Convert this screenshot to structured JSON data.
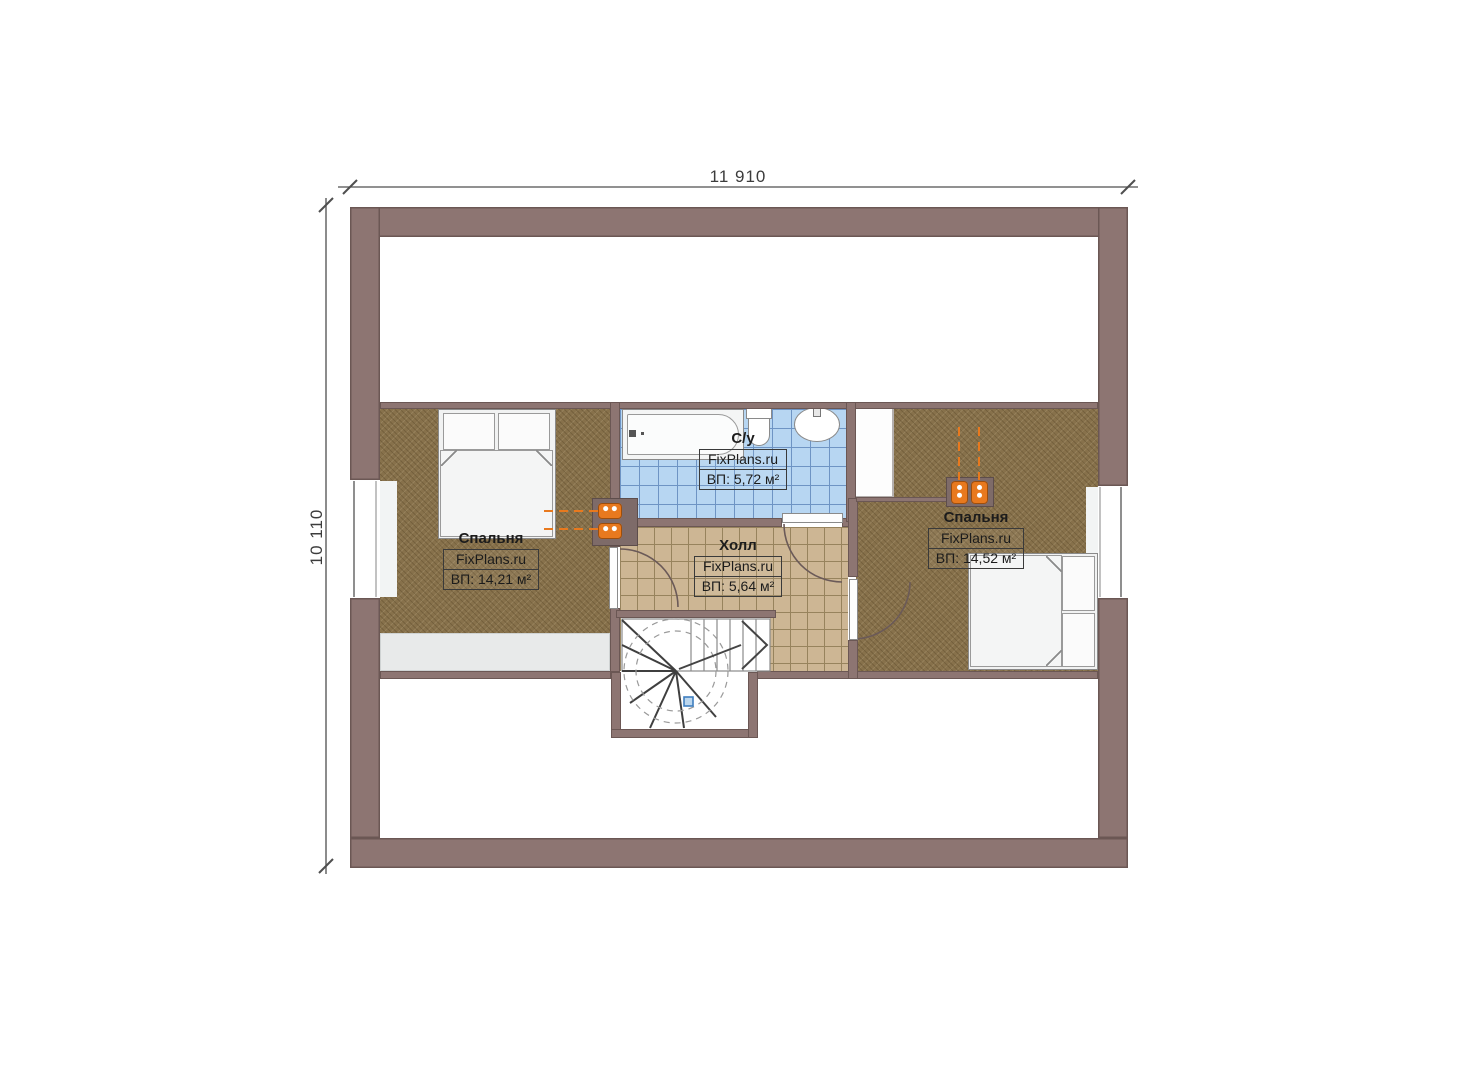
{
  "plan": {
    "dim_top": "11 910",
    "dim_left": "10 110"
  },
  "rooms": {
    "bedroom_left": {
      "name": "Спальня",
      "watermark": "FixPlans.ru",
      "area": "ВП: 14,21 м²"
    },
    "bathroom": {
      "name": "С/у",
      "watermark": "FixPlans.ru",
      "area": "ВП: 5,72 м²"
    },
    "hall": {
      "name": "Холл",
      "watermark": "FixPlans.ru",
      "area": "ВП: 5,64 м²"
    },
    "bedroom_right": {
      "name": "Спальня",
      "watermark": "FixPlans.ru",
      "area": "ВП: 14,52 м²"
    }
  },
  "colors": {
    "wall": "#8d7572",
    "wall_edge": "#6b5754",
    "floor_bedroom": "#87714b",
    "tile_bath": "#b7d6f2",
    "tile_bath_grid": "#6e94c4",
    "tile_hall": "#cdb694",
    "tile_hall_grid": "#97835d",
    "ledge": "#e8eaea",
    "fixture_orange": "#e8791e",
    "dim_line": "#4f4f4f",
    "label_text": "#1c1c1c"
  }
}
